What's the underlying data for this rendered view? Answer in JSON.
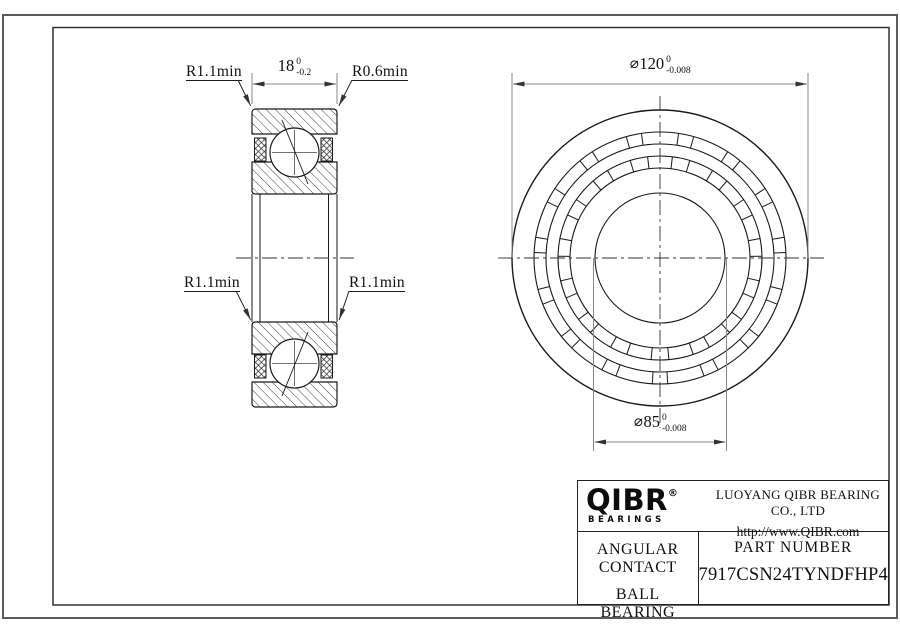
{
  "drawing": {
    "section_view": {
      "radius_top_left": "R1.1min",
      "radius_top_right": "R0.6min",
      "radius_mid_left": "R1.1min",
      "radius_mid_right": "R1.1min",
      "width_dim": {
        "value": "18",
        "tol_upper": "0",
        "tol_lower": "-0.2"
      }
    },
    "front_view": {
      "outer_dia": {
        "dia": "⌀",
        "value": "120",
        "tol_upper": "0",
        "tol_lower": "-0.008"
      },
      "bore_dia": {
        "dia": "⌀",
        "value": "85",
        "tol_upper": "0",
        "tol_lower": "-0.008"
      }
    }
  },
  "title_block": {
    "brand": {
      "name": "QIBR",
      "reg": "®",
      "tagline": "BEARINGS"
    },
    "company_name": "LUOYANG QIBR BEARING CO., LTD",
    "website": "http://www.QIBR.com",
    "product_type_line1": "ANGULAR CONTACT",
    "product_type_line2": "BALL BEARING",
    "part_number_label": "PART NUMBER",
    "part_number": "7917CSN24TYNDFHP4"
  }
}
